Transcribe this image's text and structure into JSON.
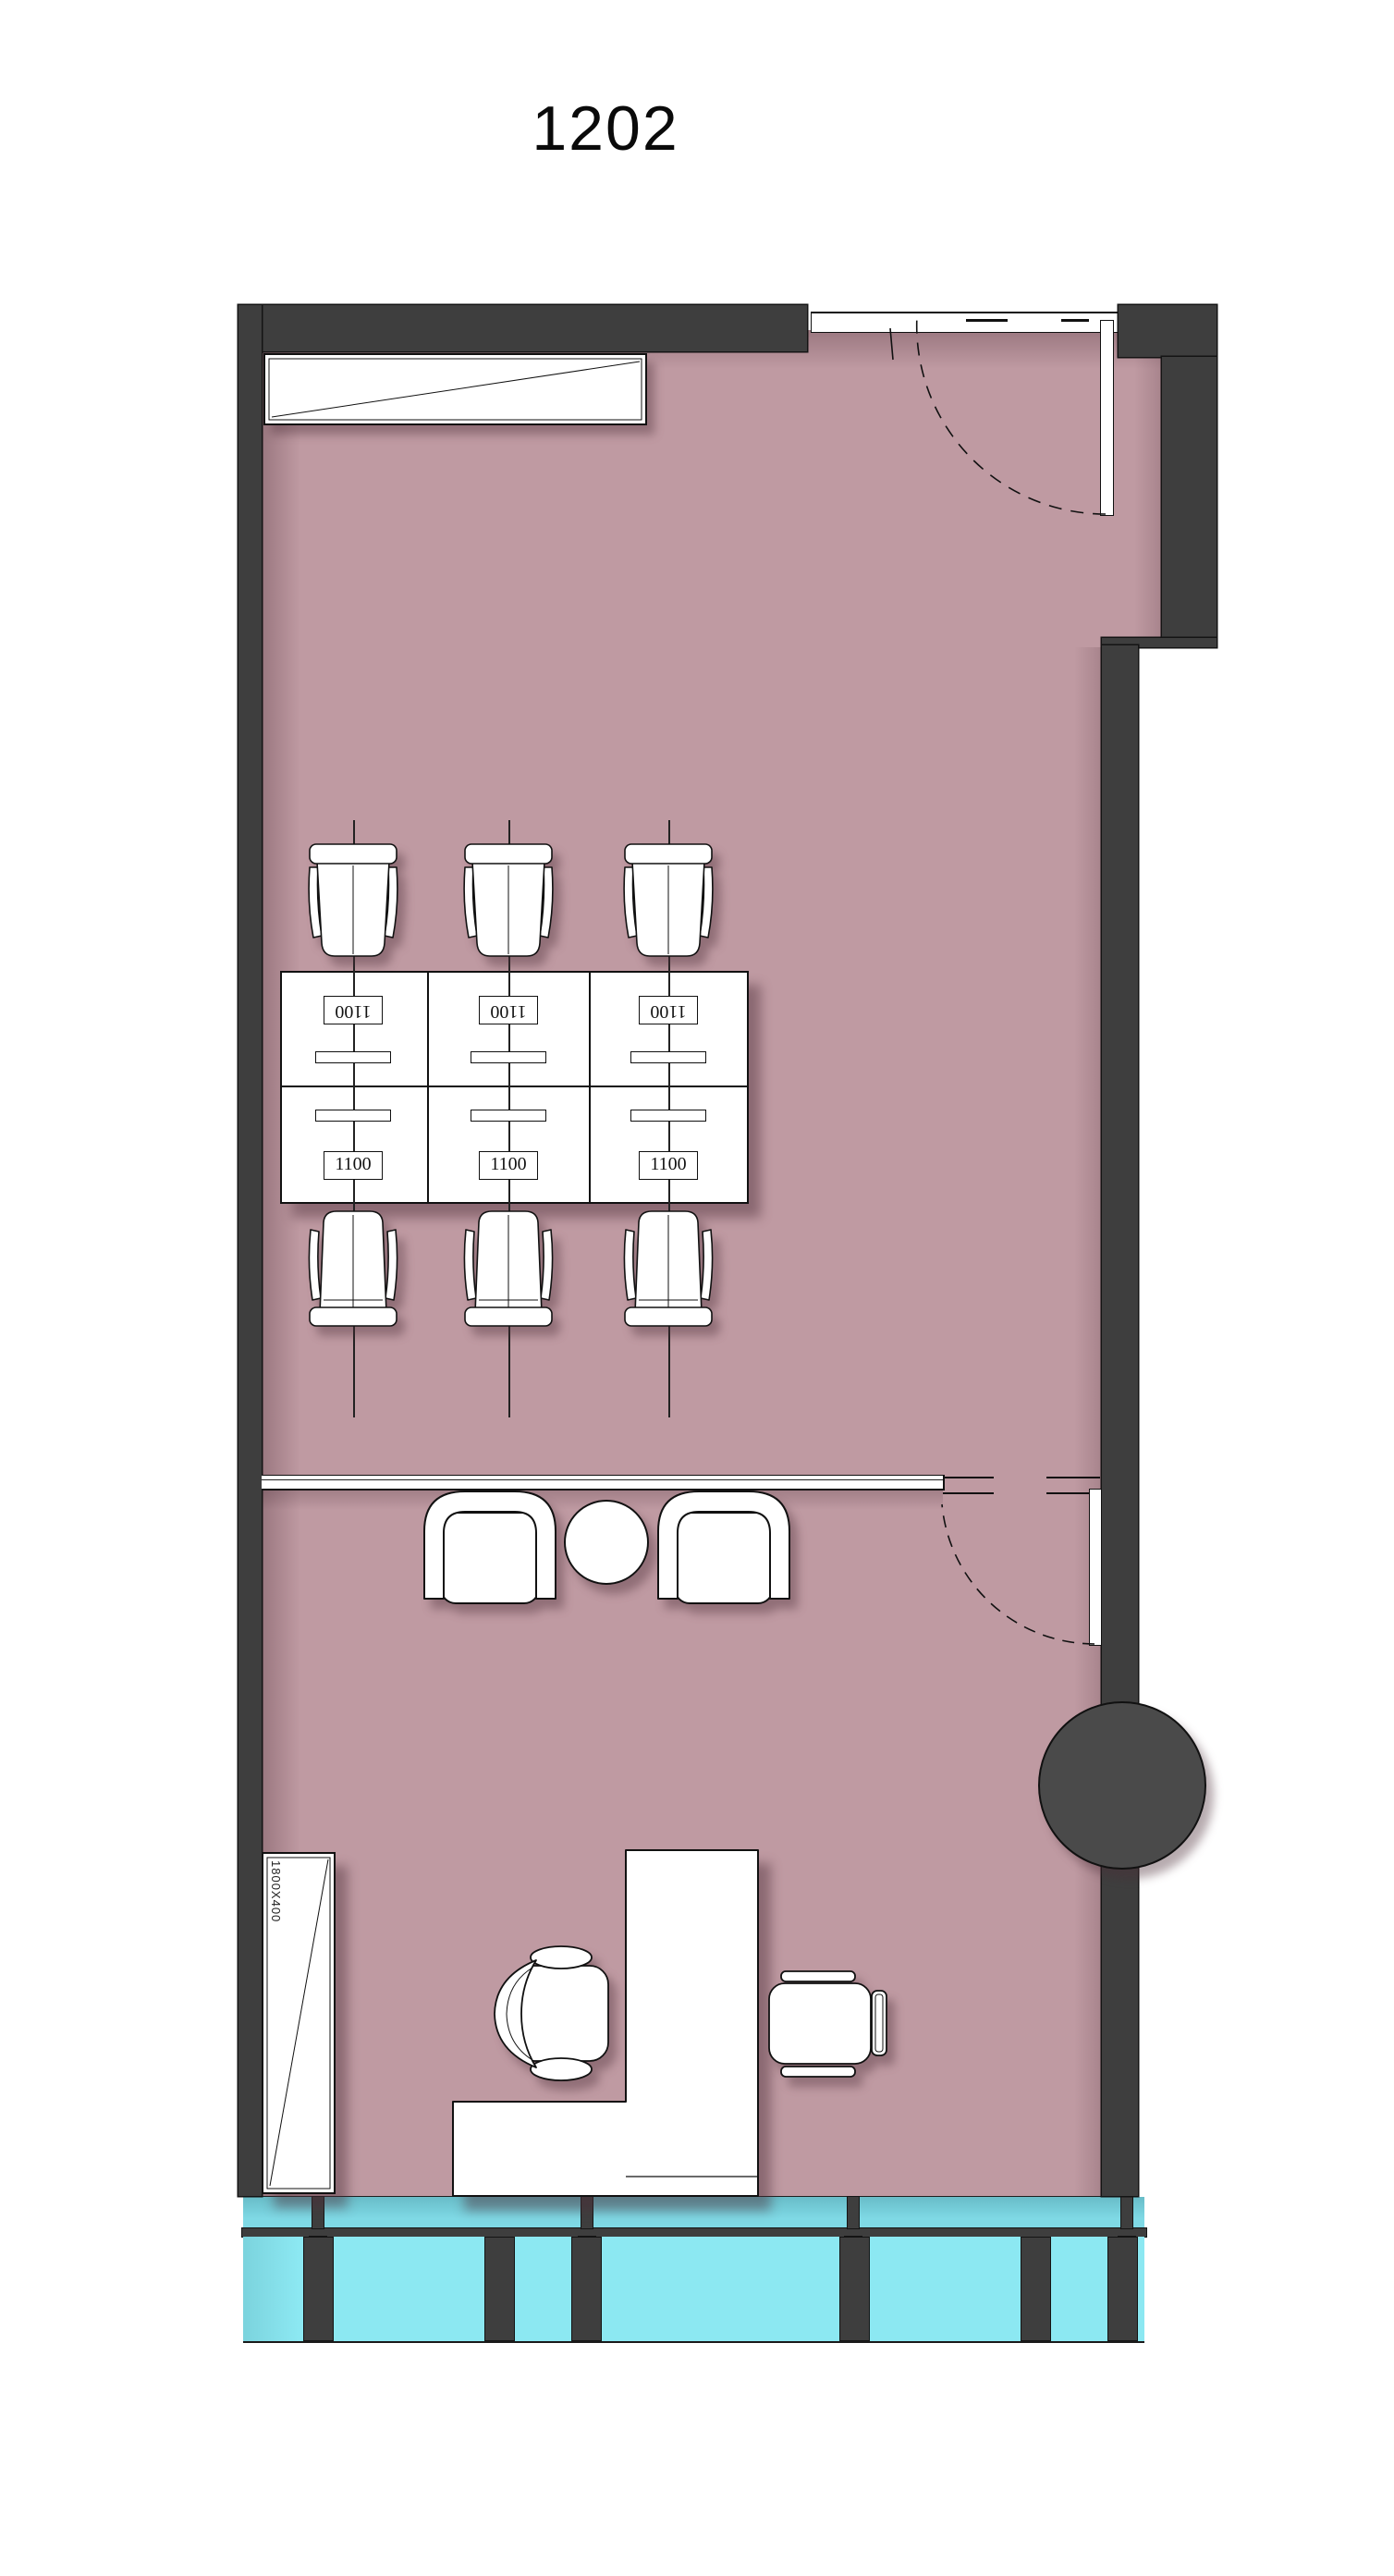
{
  "room": {
    "number": "1202"
  },
  "workstations": {
    "rows": 2,
    "columns": 3,
    "desk_labels_top": [
      "1100",
      "1100",
      "1100"
    ],
    "desk_labels_bottom": [
      "1100",
      "1100",
      "1100"
    ]
  },
  "cabinet": {
    "size_label": "1800X400"
  },
  "colors": {
    "wall": "#3e3e3e",
    "floor": "#bf9aa2",
    "glazing_upper": "#7fd9e5",
    "glazing_lower": "#8ce8f2",
    "column": "#4a4a4a",
    "furniture": "#ffffff",
    "outline": "#141414"
  }
}
